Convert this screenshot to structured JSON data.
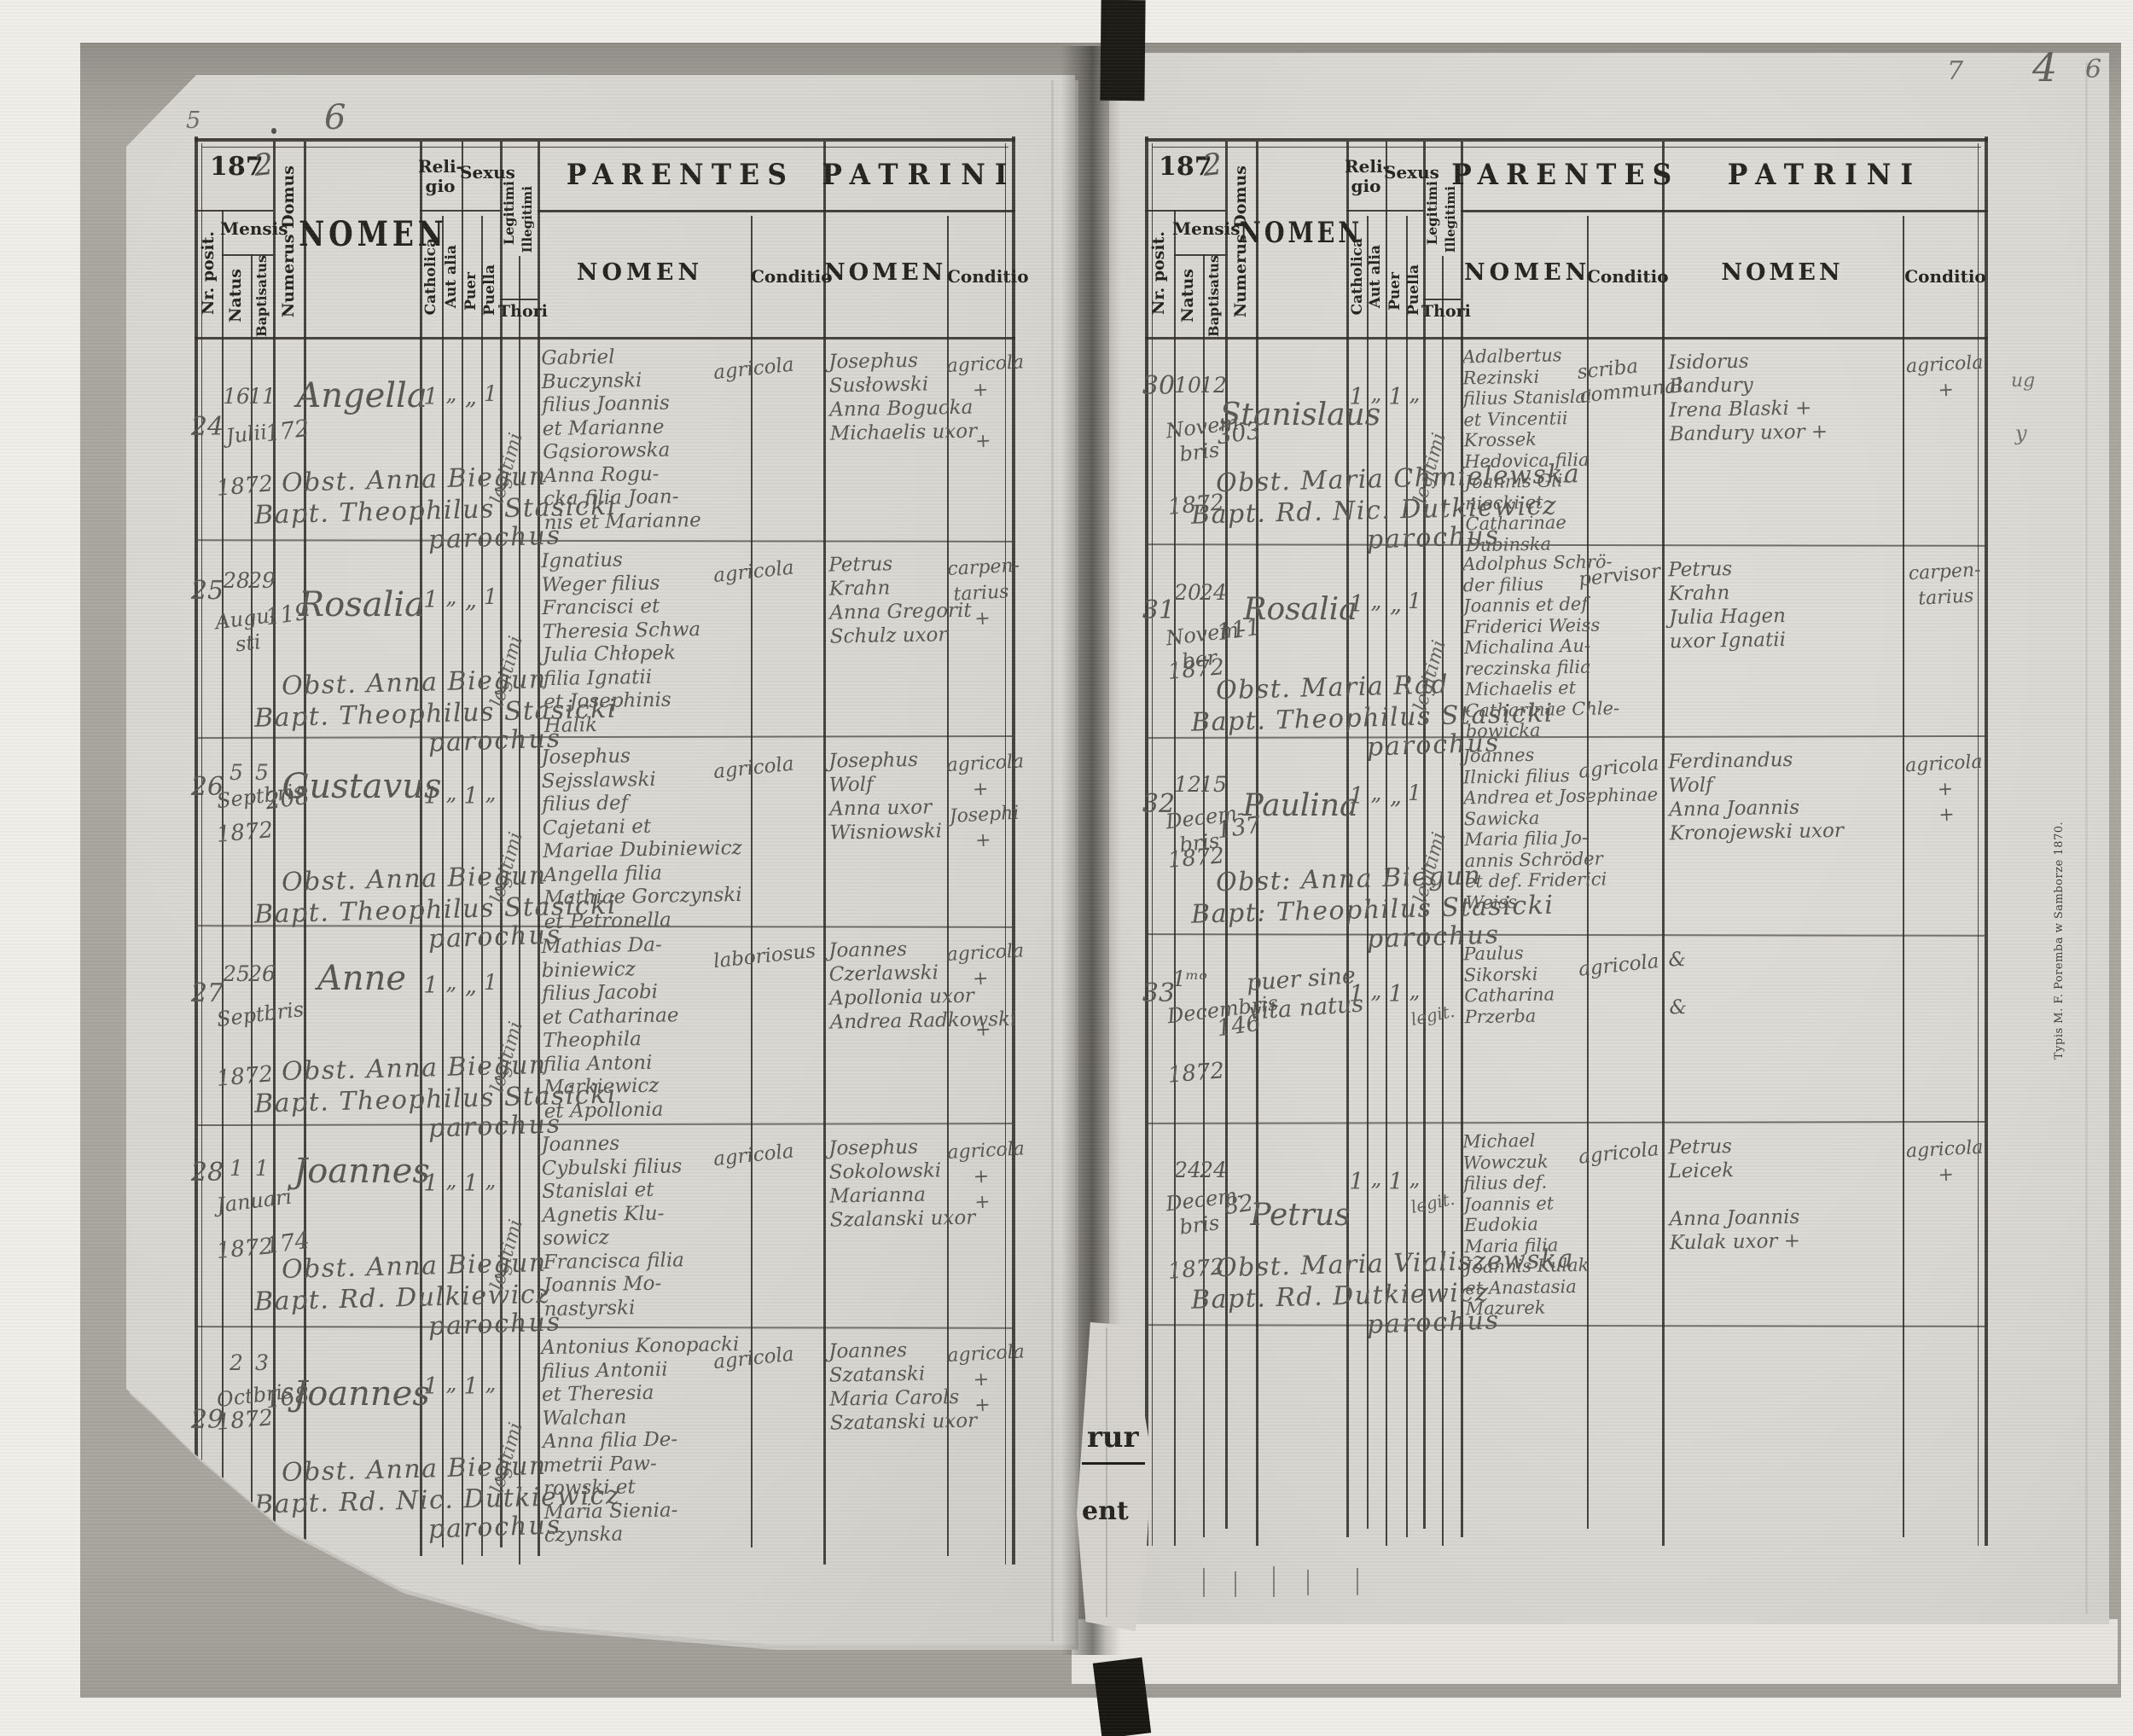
{
  "header": {
    "year_printed": "187",
    "year_hand": "2",
    "nr_posit": "Nr. posit.",
    "mensis": "Mensis",
    "natus": "Natus",
    "baptisatus": "Baptisatus",
    "numerus_domus": "Numerus Domus",
    "nomen": "NOMEN",
    "religio": "Reli-\ngio",
    "catholica": "Catholica",
    "aut_alia": "Aut alia",
    "sexus": "Sexus",
    "puer": "Puer",
    "puella": "Puella",
    "legitimi": "Legitimi",
    "illegitimi": "Illegitimi",
    "thori": "Thori",
    "parentes": "PARENTES",
    "patrini": "PATRINI",
    "nomen_sub": "NOMEN",
    "conditio": "Conditio"
  },
  "corner_numbers": {
    "left_small": "5",
    "left_page": "6",
    "right_note": "7",
    "right_page": "4",
    "right_small": "6"
  },
  "margin": {
    "imprint": "Typis M. F. Poremba w Samborze 1870.",
    "fragment_top": "rur",
    "fragment_bottom": "ent",
    "mark_a": "ug",
    "mark_b": "y"
  },
  "left_rows": [
    {
      "nr": "24",
      "born": "16",
      "bapt": "11",
      "month": "Julii",
      "year": "1872",
      "domus": "172",
      "name": "Angella",
      "cath": "1",
      "aut": "„",
      "puer": "„",
      "puella": "1",
      "legit": "legitimi",
      "obst": "Obst. Anna Biegun",
      "priest": "Bapt. Theophilus Stasicki",
      "parochus": "parochus",
      "parentes": "Gabriel\nBuczynski\nfilius Joannis\net Marianne\nGąsiorowska\nAnna Rogu-\ncka filia Joan-\nnis et Marianne",
      "par_cond": "agricola",
      "patrini": "Josephus\nSusłowski\nAnna Bogucka\nMichaelis uxor",
      "pat_cond": "agricola\n+\n\n+"
    },
    {
      "nr": "25",
      "born": "28",
      "bapt": "29",
      "month": "Augu-\nsti",
      "year": "",
      "domus": "119",
      "name": "Rosalia",
      "cath": "1",
      "aut": "„",
      "puer": "„",
      "puella": "1",
      "legit": "legitimi",
      "obst": "Obst. Anna Biegun",
      "priest": "Bapt. Theophilus Stasicki",
      "parochus": "parochus",
      "parentes": "Ignatius\nWeger filius\nFrancisci et\nTheresia Schwa\nJulia Chłopek\nfilia Ignatii\net Josephinis\nHalik",
      "par_cond": "agricola",
      "patrini": "Petrus\nKrahn\nAnna Gregorit\nSchulz uxor",
      "pat_cond": "carpen-\ntarius\n+"
    },
    {
      "nr": "26",
      "born": "5",
      "bapt": "5",
      "month": "Septbris",
      "year": "1872",
      "domus": "208",
      "name": "Gustavus",
      "cath": "1",
      "aut": "„",
      "puer": "1",
      "puella": "„",
      "legit": "legitimi",
      "obst": "Obst. Anna Biegun",
      "priest": "Bapt. Theophilus Stasicki",
      "parochus": "parochus",
      "parentes": "Josephus\nSejsslawski\nfilius def\nCajetani et\nMariae Dubiniewicz\nAngella filia\nMathiae Gorczynski\net Petronella",
      "par_cond": "agricola",
      "patrini": "Josephus\nWolf\nAnna uxor\nWisniowski",
      "pat_cond": "agricola\n+\nJosephi\n+"
    },
    {
      "nr": "27",
      "born": "25",
      "bapt": "26",
      "month": "Septbris",
      "year": "1872",
      "domus": "",
      "name": "Anne",
      "cath": "1",
      "aut": "„",
      "puer": "„",
      "puella": "1",
      "legit": "legitimi",
      "obst": "Obst. Anna Biegun",
      "priest": "Bapt. Theophilus Stasicki",
      "parochus": "parochus",
      "parentes": "Mathias Da-\nbiniewicz\nfilius Jacobi\net Catharinae\nTheophila\nfilia Antoni\nMarkiewicz\net Apollonia",
      "par_cond": "laboriosus",
      "patrini": "Joannes\nCzerlawski\nApollonia uxor\nAndrea Radkowski",
      "pat_cond": "agricola\n+\n\n+"
    },
    {
      "nr": "28",
      "born": "1",
      "bapt": "1",
      "month": "Januari",
      "year": "1872",
      "domus": "174",
      "name": "Joannes",
      "cath": "1",
      "aut": "„",
      "puer": "1",
      "puella": "„",
      "legit": "legitimi",
      "obst": "Obst. Anna Biegun",
      "priest": "Bapt. Rd. Dulkiewicz",
      "parochus": "parochus",
      "parentes": "Joannes\nCybulski filius\nStanislai et\nAgnetis Klu-\nsowicz\nFrancisca filia\nJoannis Mo-\nnastyrski",
      "par_cond": "agricola",
      "patrini": "Josephus\nSokolowski\nMarianna\nSzalanski uxor",
      "pat_cond": "agricola\n+\n+"
    },
    {
      "nr": "29",
      "born": "2",
      "bapt": "3",
      "month": "Octbris",
      "year": "1872",
      "domus": "168",
      "name": "Joannes",
      "cath": "1",
      "aut": "„",
      "puer": "1",
      "puella": "„",
      "legit": "legitimi",
      "obst": "Obst. Anna Biegun",
      "priest": "Bapt. Rd. Nic. Dutkiewicz",
      "parochus": "parochus",
      "parentes": "Antonius Konopacki\nfilius Antonii\net Theresia\nWalchan\nAnna filia De-\nmetrii Paw-\nrowski et\nMaria Sienia-\nczynska",
      "par_cond": "agricola",
      "patrini": "Joannes\nSzatanski\nMaria Carols\nSzatanski uxor",
      "pat_cond": "agricola\n+\n+"
    }
  ],
  "right_rows": [
    {
      "nr": "30",
      "born": "10",
      "bapt": "12",
      "month": "Novem-\nbris",
      "year": "1872",
      "domus": "303",
      "name": "Stanislaus",
      "cath": "1",
      "aut": "„",
      "puer": "1",
      "puella": "„",
      "legit": "legitimi",
      "obst": "Obst. Maria Chmielewska",
      "priest": "Bapt. Rd. Nic. Dutkiewicz",
      "parochus": "parochus",
      "parentes": "Adalbertus\nRezinski\nfilius Stanislai\net Vincentii\nKrossek\nHedovica filia\nJoannis Gli-\nniecki et\nCatharinae\nDubinska",
      "par_cond": "scriba\ncommunal.",
      "patrini": "Isidorus\nBandury\nIrena Blaski +\nBandury uxor +",
      "pat_cond": "agricola\n+"
    },
    {
      "nr": "31",
      "born": "20",
      "bapt": "24",
      "month": "Novem-\nber",
      "year": "1872",
      "domus": "111",
      "name": "Rosalia",
      "cath": "1",
      "aut": "„",
      "puer": "„",
      "puella": "1",
      "legit": "legitimi",
      "obst": "Obst. Maria Rad",
      "priest": "Bapt. Theophilus Stasicki",
      "parochus": "parochus",
      "parentes": "Adolphus Schrö-\nder filius\nJoannis et def\nFriderici Weiss\nMichalina Au-\nreczinska filia\nMichaelis et\nCatharinae Chle-\nbowicka",
      "par_cond": "pervisor",
      "patrini": "Petrus\nKrahn\nJulia Hagen\nuxor Ignatii",
      "pat_cond": "carpen-\ntarius"
    },
    {
      "nr": "32",
      "born": "12",
      "bapt": "15",
      "month": "Decem-\nbris",
      "year": "1872",
      "domus": "137",
      "name": "Paulina",
      "cath": "1",
      "aut": "„",
      "puer": "„",
      "puella": "1",
      "legit": "legitimi",
      "obst": "Obst: Anna Biegun",
      "priest": "Bapt: Theophilus Stasicki",
      "parochus": "parochus",
      "parentes": "Joannes\nIlnicki filius\nAndrea et Josephinae\nSawicka\nMaria filia Jo-\nannis Schröder\net def. Friderici\nWeiss",
      "par_cond": "agricola",
      "patrini": "Ferdinandus\nWolf\nAnna Joannis\nKronojewski uxor",
      "pat_cond": "agricola\n+\n+"
    },
    {
      "nr": "33",
      "born": "1ᵐᵒ",
      "bapt": "",
      "month": "Decembris",
      "year": "1872",
      "domus": "146",
      "name": "puer sine\nvita natus",
      "cath": "1",
      "aut": "„",
      "puer": "1",
      "puella": "„",
      "legit": "legit.",
      "obst": "",
      "priest": "",
      "parochus": "",
      "parentes": "Paulus\nSikorski\nCatharina\nPrzerba",
      "par_cond": "agricola",
      "patrini": "&\n\n&",
      "pat_cond": ""
    },
    {
      "nr": "",
      "born": "24",
      "bapt": "24",
      "month": "Decem-\nbris",
      "year": "1872",
      "domus": "82",
      "name": "Petrus",
      "cath": "1",
      "aut": "„",
      "puer": "1",
      "puella": "„",
      "legit": "legit.",
      "obst": "Obst. Maria Vialiszewska",
      "priest": "Bapt. Rd. Dutkiewicz",
      "parochus": "parochus",
      "parentes": "Michael\nWowczuk\nfilius def.\nJoannis et\nEudokia\nMaria filia\nJoannis Kulak\net Anastasia\nMazurek",
      "par_cond": "agricola",
      "patrini": "Petrus\nLeicek\n\nAnna Joannis\nKulak uxor +",
      "pat_cond": "agricola\n+"
    }
  ]
}
